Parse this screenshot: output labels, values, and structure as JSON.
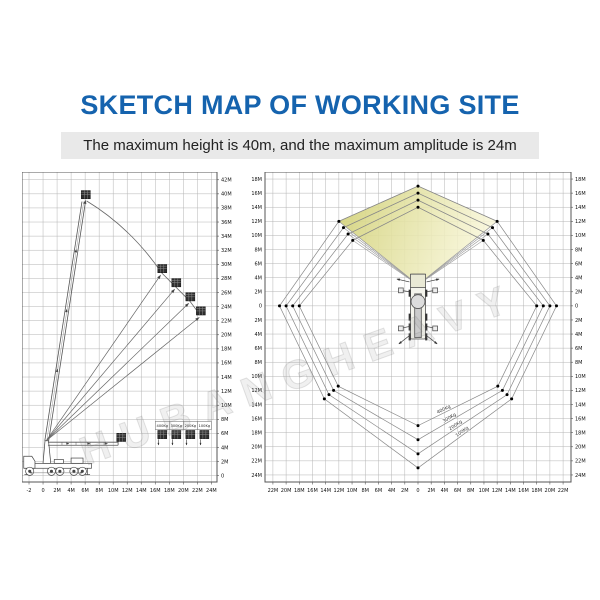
{
  "header": {
    "title": "SKETCH MAP OF WORKING SITE",
    "subtitle": "The maximum height is 40m, and the maximum amplitude is 24m"
  },
  "watermark": {
    "text": "HUBANGHEAVY"
  },
  "colors": {
    "title_blue": "#1563ae",
    "subtitle_band": "#e9e9e9",
    "grid": "#b4b4b4",
    "border": "#555555",
    "line": "#666666",
    "fan_left": "#d2d178",
    "fan_right": "#f8f6d8",
    "dot": "#000000"
  },
  "chart_data": [
    {
      "id": "side-elevation",
      "type": "line",
      "title": "Side view working envelope",
      "x_range": [
        -3,
        24.8
      ],
      "y_range": [
        -0.9,
        43.1
      ],
      "x_ticks": [
        "-2",
        "0",
        "2M",
        "4M",
        "6M",
        "8M",
        "10M",
        "12M",
        "14M",
        "16M",
        "18M",
        "20M",
        "22M",
        "24M"
      ],
      "x_tick_start": -2,
      "x_tick_step": 2,
      "y_ticks": [
        "42M",
        "40M",
        "38M",
        "36M",
        "34M",
        "32M",
        "30M",
        "28M",
        "26M",
        "24M",
        "22M",
        "20M",
        "18M",
        "16M",
        "14M",
        "12M",
        "10M",
        "8M",
        "6M",
        "4M",
        "2M",
        "0"
      ],
      "y_tick_start": 42,
      "y_tick_step": -2,
      "grid_x": [
        -2,
        24
      ],
      "grid_y": [
        0,
        42
      ],
      "max_height_m": 40,
      "max_amplitude_m": 24,
      "turret": [
        0.45,
        4.95
      ],
      "boom_tip": [
        5.8,
        38.9
      ],
      "top_platform": [
        6.1,
        39.3
      ],
      "envelope_points": [
        [
          17,
          28.7
        ],
        [
          19,
          26.7
        ],
        [
          21,
          24.7
        ],
        [
          22.5,
          22.7
        ]
      ],
      "stowed_platform": [
        11.15,
        4.85
      ],
      "ground_platforms": [
        [
          17,
          5.25
        ],
        [
          19,
          5.25
        ],
        [
          21,
          5.25
        ],
        [
          23,
          5.25
        ]
      ],
      "capacity_labels": [
        "400Kg",
        "300Kg",
        "200Kg",
        "100Kg"
      ]
    },
    {
      "id": "plan-view",
      "type": "line",
      "title": "Top view working area",
      "x_range": [
        -23.2,
        23.2
      ],
      "y_range": [
        -25,
        19
      ],
      "x_ticks": [
        "22M",
        "20M",
        "18M",
        "16M",
        "14M",
        "12M",
        "10M",
        "8M",
        "6M",
        "4M",
        "2M",
        "0",
        "2M",
        "4M",
        "6M",
        "8M",
        "10M",
        "12M",
        "14M",
        "16M",
        "18M",
        "20M",
        "22M"
      ],
      "x_tick_start": -22,
      "x_tick_step": 2,
      "y_ticks": [
        "18M",
        "16M",
        "14M",
        "12M",
        "10M",
        "8M",
        "6M",
        "4M",
        "2M",
        "0",
        "2M",
        "4M",
        "6M",
        "8M",
        "10M",
        "12M",
        "14M",
        "16M",
        "18M",
        "20M",
        "22M",
        "24M"
      ],
      "y_tick_start": 18,
      "y_tick_step": -2,
      "grid_x": [
        -22,
        22
      ],
      "grid_y": [
        -24,
        18
      ],
      "fan_apex": [
        0,
        3.0
      ],
      "rings": [
        {
          "capacity": "400Kg",
          "top": 14,
          "upper": [
            9.9,
            9.3
          ],
          "side": 18,
          "lower": [
            12.1,
            -11.4
          ],
          "bottom": -17,
          "label_t": 0.33
        },
        {
          "capacity": "300Kg",
          "top": 15,
          "upper": [
            10.6,
            10.2
          ],
          "side": 19,
          "lower": [
            12.8,
            -12.0
          ],
          "bottom": -19,
          "label_t": 0.38
        },
        {
          "capacity": "200Kg",
          "top": 16,
          "upper": [
            11.3,
            11.1
          ],
          "side": 20,
          "lower": [
            13.5,
            -12.6
          ],
          "bottom": -21,
          "label_t": 0.43
        },
        {
          "capacity": "100Kg",
          "top": 17,
          "upper": [
            12.0,
            12.0
          ],
          "side": 21,
          "lower": [
            14.2,
            -13.2
          ],
          "bottom": -23,
          "label_t": 0.48
        }
      ]
    }
  ]
}
